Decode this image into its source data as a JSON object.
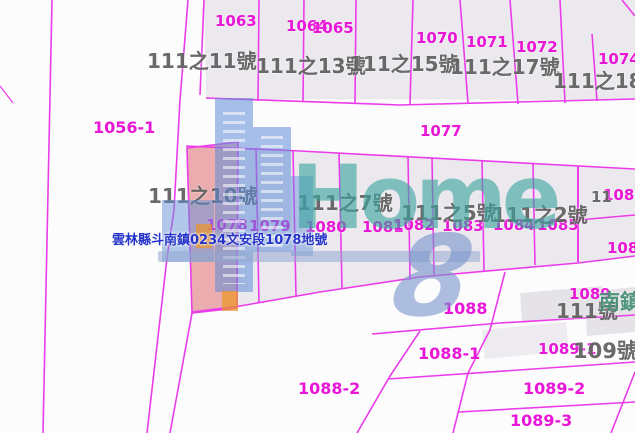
{
  "map_type": "cadastral-parcel-map",
  "parcels": {
    "p1063": "1063",
    "p1064": "1064",
    "p1065": "1065",
    "p1070": "1070",
    "p1071": "1071",
    "p1072": "1072",
    "p1074": "1074",
    "p1077": "1077",
    "p1056_1": "1056-1",
    "p1078": "1078",
    "p1079": "1079",
    "p1080": "1080",
    "p1081": "1081",
    "p1082": "1082",
    "p1083": "1083",
    "p1084": "1084",
    "p1085": "1085",
    "p1086": "1086",
    "p1087": "1087",
    "p1088": "1088",
    "p1088_1": "1088-1",
    "p1088_2": "1088-2",
    "p1089": "1089",
    "p1089_1": "1089-1",
    "p1089_2": "1089-2",
    "p1089_3": "1089-3"
  },
  "addresses": {
    "a11": "111之11號",
    "a13": "111之13號",
    "a15": "111之15號",
    "a17": "111之17號",
    "a18": "111之18號",
    "a10": "111之10號",
    "a7": "111之7號",
    "a5": "111之5號",
    "a2": "111之2號",
    "a111": "111號",
    "a109": "109號",
    "a11frag": "11"
  },
  "road_label": {
    "partial": "南鎮"
  },
  "selected_parcel": {
    "label": "雲林縣斗南鎮0234文安段1078地號",
    "parcel_no": "1078"
  },
  "watermark": {
    "word": "Home",
    "number": "8"
  },
  "colors": {
    "boundary_line": "#ea3cea",
    "parcel_number_text": "#e816d6",
    "address_text": "#505050",
    "highlight_fill": "#e97a7a",
    "info_text": "#2433c8",
    "watermark_teal": "#3aa59e",
    "watermark_blue": "#5f8cd7",
    "parcel_fill": "#ece9ee"
  }
}
